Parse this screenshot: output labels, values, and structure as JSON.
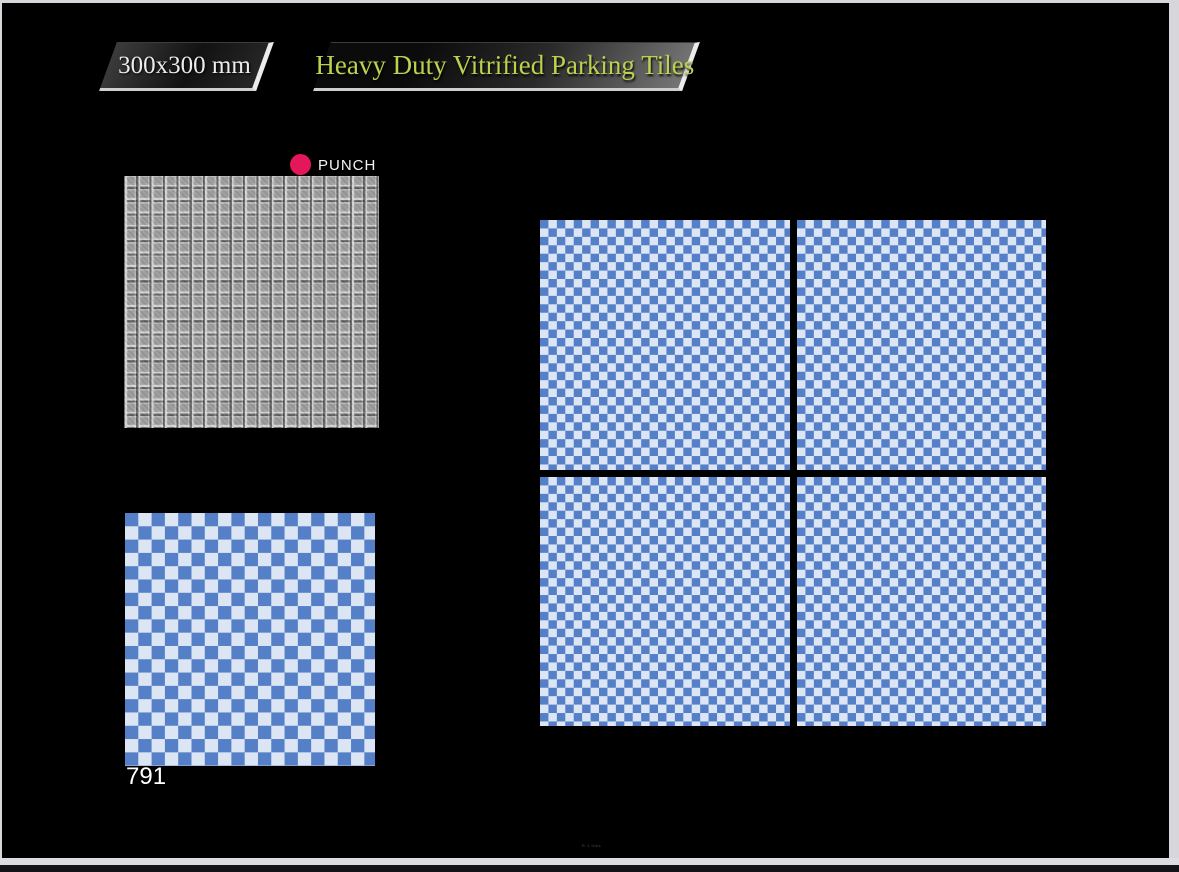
{
  "colors": {
    "canvas": "#000000",
    "frame": "#d6d6db",
    "tile_blue": "#5580c8",
    "tile_light": "#dce5f4",
    "punch_dot": "#e3175a",
    "title_text": "#bdd14f",
    "size_text": "#ececec",
    "mosaic_gray": "#9b9b9b"
  },
  "header": {
    "size_badge_label": "300x300 mm",
    "title_badge_label": "Heavy Duty Vitrified Parking Tiles"
  },
  "finish": {
    "label": "PUNCH"
  },
  "product": {
    "code": "791"
  },
  "swatches": {
    "texture_tile": {
      "type": "embossed-square-mosaic",
      "grid": "19x19",
      "color": "gray"
    },
    "design_tile": {
      "type": "checkerboard",
      "grid": "19x19"
    }
  },
  "preview": {
    "rows": 2,
    "cols": 2,
    "tile_pattern": "checkerboard"
  },
  "footer": {
    "watermark": "R-1 tiles"
  }
}
